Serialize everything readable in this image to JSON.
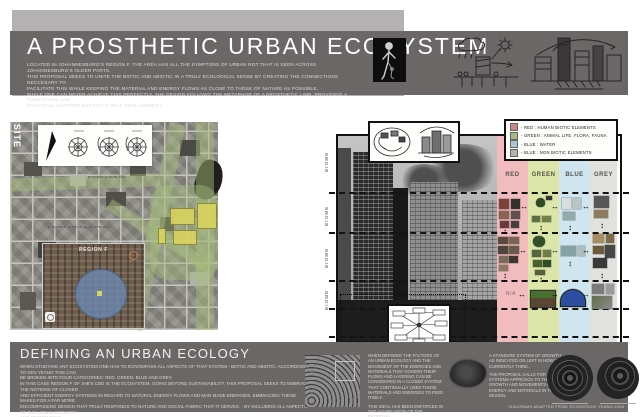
{
  "colors": {
    "band_gray": "#6b6767",
    "light_gray": "#b4b1b2",
    "column_red": "#f2bcbf",
    "column_green": "#dde6a9",
    "column_blue": "#cfe6f0",
    "column_grey": "#e1e1de",
    "map_green_overlay": "#a7be7e",
    "block_yellow": "#d9d35e",
    "inset_blue": "#6c8ab2"
  },
  "header": {
    "title": "A PROSTHETIC URBAN ECOSYSTEM",
    "intro_lines": [
      "LOCATED IN JOHANNESBURG'S REGION F. THE AREA HAS ALL THE SYMPTONS OF URBAN ROT THAT IS SEEN ACROSS JOHANNESBURG'S OLDER PARTS.",
      "THIS PROPOSAL SEEKS TO UNITE THE BIOTIC AND ABIOTIC IN A TRULY ECOLOGICAL SENSE BY CREATING THE CONNECTIONS NECCESARY TO",
      "FACILITATE THIS WHILE KEEPING THE MATERIAL AND ENERGY FLOWS AS CLOSE TO THOSE OF NATURE AS POSSIBLE.",
      "WHILE ONE CAN NEVER ACHIEVE THIS PERFECTLY, THE DESIGN FOLLOWS THE METAPHOR OF A PROSTHETIC LIMB, PROVIDING A FUNCTIONAL AND",
      "PRACTICAL SUPPORT BUT NOT A TRUE REPLACEMENT."
    ]
  },
  "site_map": {
    "site_label": "SITE",
    "annotation_wind": "prevailing wind NW",
    "annotation_green": "proposed green egg of new city",
    "inset_label": "REGION F"
  },
  "biome_figure": {
    "biome_labels": [
      "BIOME",
      "BIOME",
      "BIOME",
      "BIOME"
    ],
    "na_label": "N/A",
    "columns": [
      {
        "label": "RED"
      },
      {
        "label": "GREEN"
      },
      {
        "label": "BLUE"
      },
      {
        "label": "GREY"
      }
    ],
    "legend_rows": [
      {
        "text": "- RED : HUMAN BIOTIC ELEMENTS"
      },
      {
        "text": "- GREEN : ANIMAL LIFE, FLORA, FAUNA"
      },
      {
        "text": "- BLUE : WATER"
      },
      {
        "text": "- BLUE : NON BIOTIC ELEMENTS"
      }
    ]
  },
  "footer": {
    "heading": "DEFINING AN URBAN ECOLOGY",
    "paragraph_lines": [
      "WHEN STUDYING ANY ECOSYSTEM ONE HAS TO ECNOMPASS ALL ASPECTS OF THAT SYSTEM - BIOTIC AND ABIOTIC. ACCORDING TO KEN YEANG THIS CAN",
      "BE BROKEN INTO FOUR CATEGORIES: RED, GREEN, BLUE AND GREY.",
      "IN THIS CASE REGION F OF JHB'S CBD IS THE ECOSYSTEM. GOING BEYOND SUSTAINABILITY, THIS PROPOSAL SEEKS TO EMBRACE THE NOTIONS OF CLOSED",
      "AND EFFICIENT ENERGY SYSTEMS IN REGARD TO NATURAL ENERGY FLOWS AND MAN MADE ENERGIES. EMBRACING THESE MAKES FOR A FAR MORE",
      "ENCOMPASSING DESIGN THAT TRULY RESPONDS TO NATURE AND SOCIAL FABRIC THAT IT SERVES. - BY INCLUDING ALL ASPECTS OF THE URBAN ECOLOGY",
      "AND RESPONDING."
    ],
    "note_left_1": "WHEN DEFINING THE FACTORS OF AN URBAN ECOLOGY AND THE MOVEMENT OF THE ENERGIES AND MATERIALS THAT GOVERN THEIR FLOWS AND LAYERING CAN BE CONSIDERED IN A CLOSED SYSTEM THAT CONTINUALLY USES THOSE MATERIALS AND ENERGIES TO FEED ITSELF.",
    "note_left_2": "THIS IDEAL HAS BEEN ENFORCED IN THE ASSIMILATION OF THE PROPOSAL.",
    "note_right_1": "A STANDARD SYSTEM OF GROWTH AS INDICATED ON LEFT IS HOW WE CURRENTLY THINK.",
    "note_right_2": "THE PROPOSAL CALLS FOR A SYSTEMS APPROACH TO THE GROWTH AND MOVEMENTS OF ENERGY AND MATERIALS IN THE DESIGN.",
    "caption": "*DIAGRAMS ADAPTED FROM 'ECODESIGN' YEANG 2008"
  }
}
